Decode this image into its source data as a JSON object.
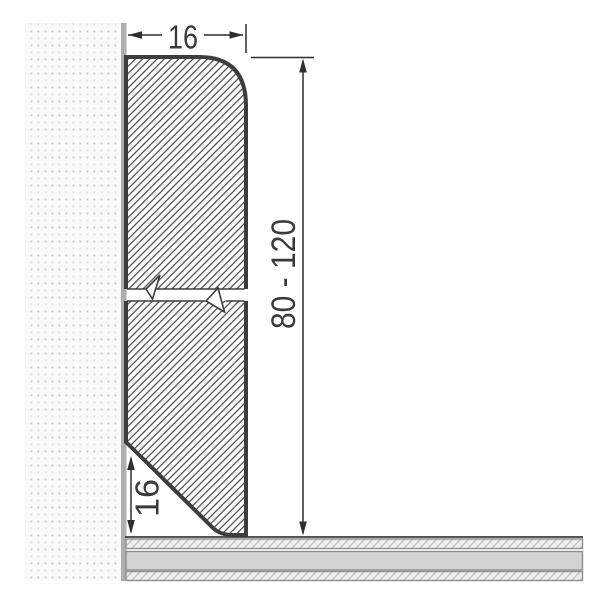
{
  "diagram": {
    "type": "technical-cross-section",
    "labels": {
      "width_top": "16",
      "height_right": "80 - 120",
      "bevel_bottom": "16"
    },
    "colors": {
      "outline": "#3d3d3d",
      "dimension_line": "#2f2f2f",
      "label_text": "#3a3a3a",
      "wall_surface": "#aeaeae",
      "wall_dot": "#cccccc",
      "hatch_line": "#474747",
      "floor_band": "#d3d3d3",
      "floor_hatch_bg": "#ececec",
      "floor_border": "#8f8f8f",
      "background": "#ffffff"
    }
  }
}
